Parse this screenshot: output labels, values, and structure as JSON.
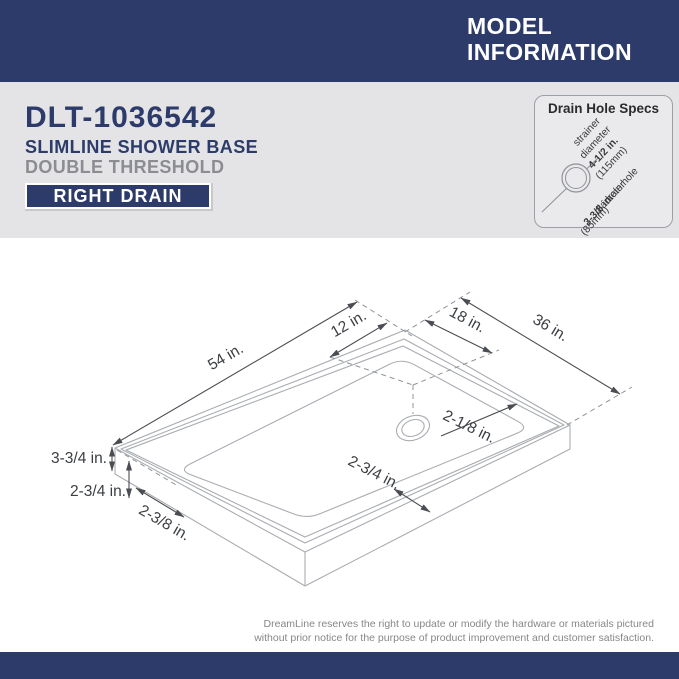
{
  "header": {
    "title_line1": "MODEL",
    "title_line2": "INFORMATION"
  },
  "product": {
    "model": "DLT-1036542",
    "name": "SLIMLINE SHOWER BASE",
    "threshold": "DOUBLE THRESHOLD",
    "drain_badge": "RIGHT DRAIN"
  },
  "drain_specs": {
    "title": "Drain Hole Specs",
    "strainer_lines": [
      "strainer",
      "diameter",
      "4-1/2 in.",
      "(115mm)"
    ],
    "drain_hole_lines": [
      "drain hole",
      "diameter",
      "3-3/8 in.",
      "(85mm)"
    ]
  },
  "diagram": {
    "dimensions": {
      "length": "54 in.",
      "drain_offset_back": "12 in.",
      "drain_offset_side": "18 in.",
      "width": "36 in.",
      "drain_lip": "2-1/8 in.",
      "front_threshold_width": "2-3/4 in.",
      "base_height": "3-3/4 in.",
      "threshold_height": "2-3/4 in.",
      "side_threshold_width": "2-3/8 in."
    }
  },
  "footer": {
    "disclaimer_line1": "DreamLine reserves the right to update or modify the hardware or materials pictured",
    "disclaimer_line2": "without prior notice for the purpose of product improvement and customer satisfaction."
  },
  "colors": {
    "navy": "#2c3b6a",
    "band_gray": "#e4e4e7",
    "box_gray": "#eaeaed",
    "outline_gray": "#a9acb1",
    "dimension_gray": "#4a4d52",
    "text_dark": "#3b3e42",
    "text_gray": "#85878a"
  }
}
